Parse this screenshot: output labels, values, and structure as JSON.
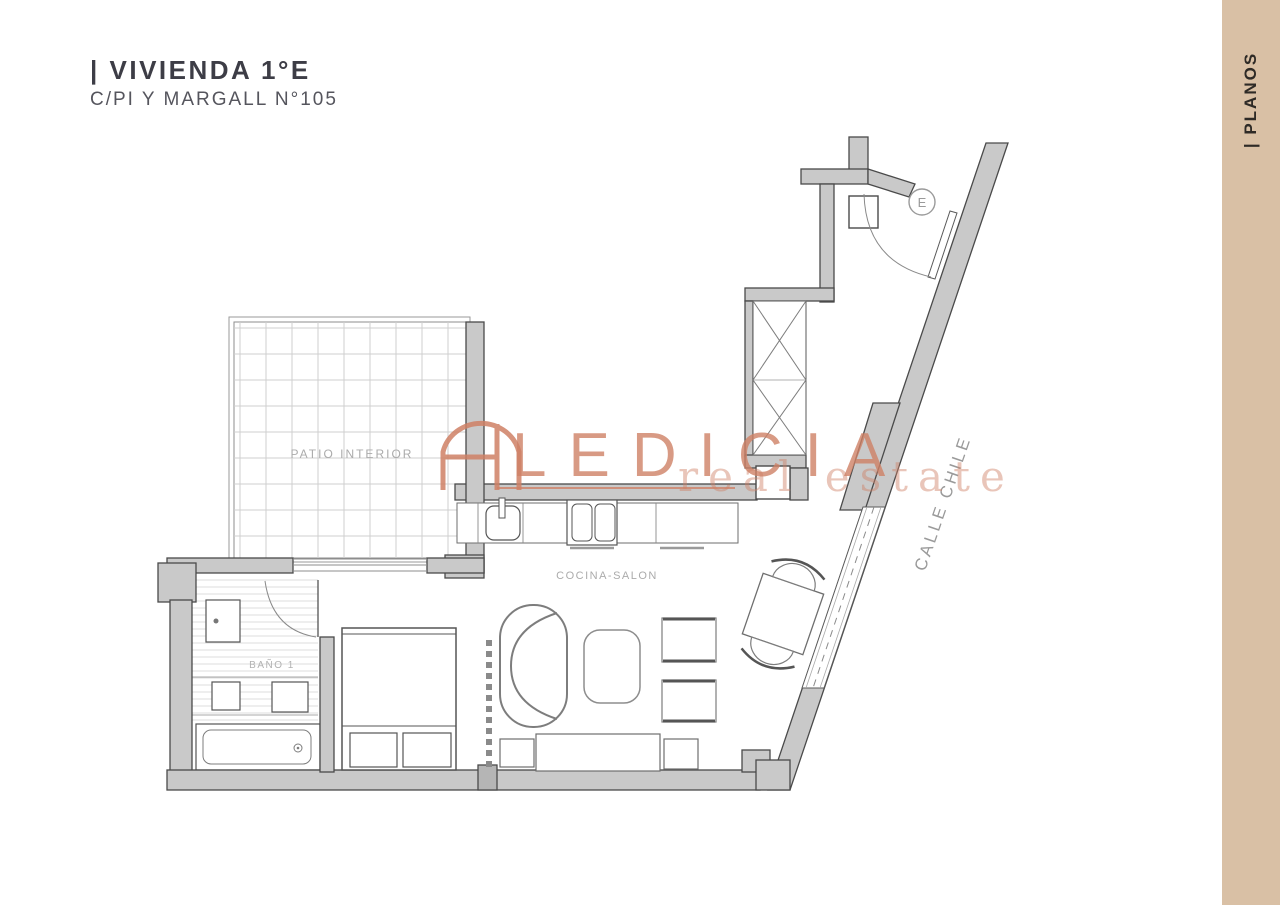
{
  "header": {
    "title": "| VIVIENDA 1°E",
    "subtitle": "C/PI Y MARGALL N°105"
  },
  "sidebar": {
    "label": "| PLANOS",
    "bg_color": "#d9c0a5"
  },
  "floorplan": {
    "rooms": [
      {
        "label": "PATIO INTERIOR"
      },
      {
        "label": "COCINA-SALON"
      },
      {
        "label": "BAÑO 1"
      }
    ],
    "street_label": "CALLE CHILE",
    "entrance_label": "E",
    "wall_fill_color": "#c9c9c9",
    "wall_line_color": "#4a4a4a",
    "label_color": "#ababab"
  },
  "watermark": {
    "brand": "LEDICIA",
    "tagline": "real estate",
    "accent_color": "#cf8166"
  }
}
